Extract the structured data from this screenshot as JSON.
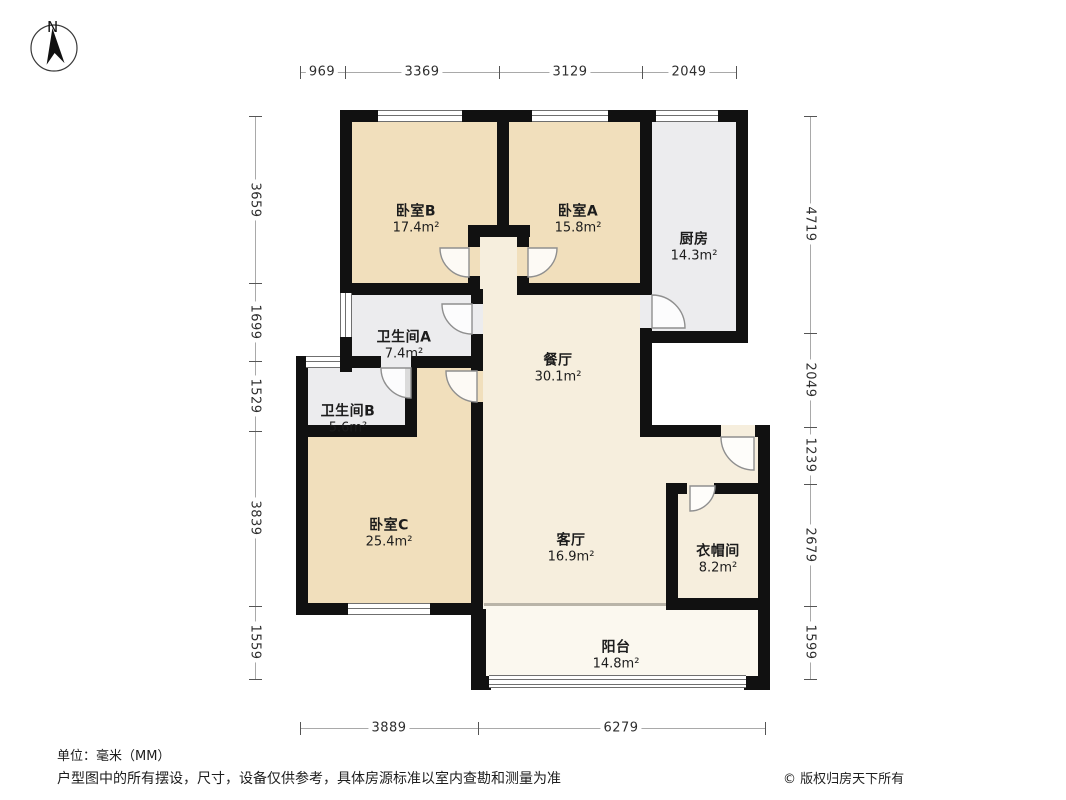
{
  "compass": {
    "north_label": "N"
  },
  "rooms": {
    "bedroom_b": {
      "name": "卧室B",
      "area": "17.4m²"
    },
    "bedroom_a": {
      "name": "卧室A",
      "area": "15.8m²"
    },
    "kitchen": {
      "name": "厨房",
      "area": "14.3m²"
    },
    "bathroom_a": {
      "name": "卫生间A",
      "area": "7.4m²"
    },
    "dining_room": {
      "name": "餐厅",
      "area": "30.1m²"
    },
    "bathroom_b": {
      "name": "卫生间B",
      "area": "5.6m²"
    },
    "bedroom_c": {
      "name": "卧室C",
      "area": "25.4m²"
    },
    "living_room": {
      "name": "客厅",
      "area": "16.9m²"
    },
    "cloakroom": {
      "name": "衣帽间",
      "area": "8.2m²"
    },
    "balcony": {
      "name": "阳台",
      "area": "14.8m²"
    }
  },
  "dimensions_mm": {
    "top": [
      "969",
      "3369",
      "3129",
      "2049"
    ],
    "left": [
      "3659",
      "1699",
      "1529",
      "3839",
      "1559"
    ],
    "right": [
      "4719",
      "2049",
      "1239",
      "2679",
      "1599"
    ],
    "bottom": [
      "3889",
      "6279"
    ]
  },
  "footer": {
    "unit": "单位：毫米（MM）",
    "disclaimer": "户型图中的所有摆设，尺寸，设备仅供参考，具体房源标准以室内查勘和测量为准",
    "copyright": "© 版权归房天下所有"
  },
  "colors": {
    "wall": "#111111",
    "bedroom_fill": "#f1dfbc",
    "living_fill": "#f6eedd",
    "service_fill": "#ececee",
    "balcony_fill": "#fbf8ef"
  }
}
